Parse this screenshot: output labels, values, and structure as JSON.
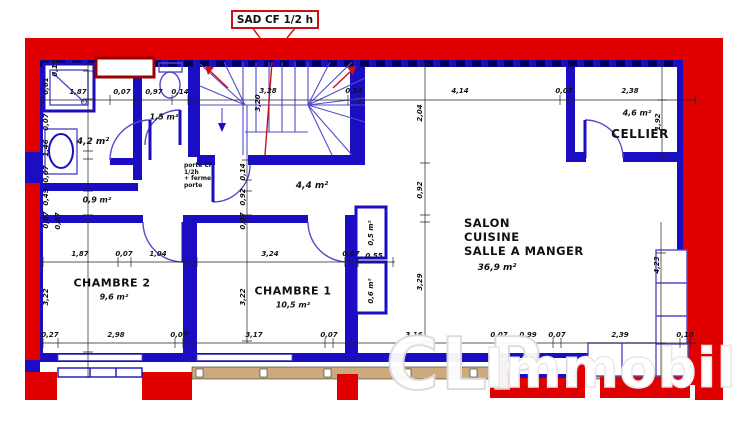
{
  "title_callout": "SAD CF 1/2 h",
  "watermark": {
    "part1": "CLP",
    "part2": "Immobilier"
  },
  "door_note": "porte CF\n1/2h\n+ ferme\nporte",
  "colors": {
    "wall_red": "#e10000",
    "wall_blue": "#1b0dc1",
    "arc_blue": "#544bc9",
    "dark_red": "#990000",
    "tan": "#cdaa7d",
    "section_red": "#cc1111"
  },
  "rooms": {
    "bathroom": {
      "area": "4,2 m²"
    },
    "wc": {
      "area": "1,5 m²"
    },
    "storage": {
      "area": "0,9 m²"
    },
    "hall": {
      "area": "4,4 m²"
    },
    "cellier": {
      "name": "CELLIER",
      "area": "4,6 m²"
    },
    "salon": {
      "line1": "SALON",
      "line2": "CUISINE",
      "line3": "SALLE A MANGER",
      "area": "36,9 m²"
    },
    "chambre2": {
      "name": "CHAMBRE 2",
      "area": "9,6 m²"
    },
    "chambre1": {
      "name": "CHAMBRE 1",
      "area": "10,5 m²"
    },
    "closet_top": {
      "area": "0,5 m²"
    },
    "closet_bottom": {
      "area": "0,6 m²"
    }
  },
  "dimensions": [
    {
      "t": "1,87",
      "x": 78,
      "y": 92,
      "r": 0
    },
    {
      "t": "0,07",
      "x": 122,
      "y": 92,
      "r": 0
    },
    {
      "t": "0,97",
      "x": 154,
      "y": 92,
      "r": 0
    },
    {
      "t": "0,14",
      "x": 180,
      "y": 92,
      "r": 0
    },
    {
      "t": "3,28",
      "x": 268,
      "y": 91,
      "r": 0
    },
    {
      "t": "0,14",
      "x": 354,
      "y": 91,
      "r": 0
    },
    {
      "t": "4,14",
      "x": 460,
      "y": 91,
      "r": 0
    },
    {
      "t": "0,07",
      "x": 564,
      "y": 91,
      "r": 0
    },
    {
      "t": "2,38",
      "x": 630,
      "y": 91,
      "r": 0
    },
    {
      "t": "0,15",
      "x": 55,
      "y": 68,
      "r": 1
    },
    {
      "t": "0,61",
      "x": 46,
      "y": 86,
      "r": 1
    },
    {
      "t": "0,07",
      "x": 46,
      "y": 122,
      "r": 1
    },
    {
      "t": "1,46",
      "x": 46,
      "y": 148,
      "r": 1
    },
    {
      "t": "0,07",
      "x": 46,
      "y": 174,
      "r": 1
    },
    {
      "t": "0,49",
      "x": 46,
      "y": 197,
      "r": 1
    },
    {
      "t": "0,07",
      "x": 46,
      "y": 220,
      "r": 1
    },
    {
      "t": "3,22",
      "x": 46,
      "y": 297,
      "r": 1
    },
    {
      "t": "1,87",
      "x": 80,
      "y": 254,
      "r": 0
    },
    {
      "t": "0,07",
      "x": 124,
      "y": 254,
      "r": 0
    },
    {
      "t": "1,04",
      "x": 158,
      "y": 254,
      "r": 0
    },
    {
      "t": "3,24",
      "x": 270,
      "y": 254,
      "r": 0
    },
    {
      "t": "0,07",
      "x": 351,
      "y": 254,
      "r": 0
    },
    {
      "t": "0,55",
      "x": 374,
      "y": 256,
      "r": 0
    },
    {
      "t": "0,27",
      "x": 50,
      "y": 335,
      "r": 0
    },
    {
      "t": "2,98",
      "x": 116,
      "y": 335,
      "r": 0
    },
    {
      "t": "0,07",
      "x": 179,
      "y": 335,
      "r": 0
    },
    {
      "t": "3,17",
      "x": 254,
      "y": 335,
      "r": 0
    },
    {
      "t": "0,07",
      "x": 329,
      "y": 335,
      "r": 0
    },
    {
      "t": "3,16",
      "x": 414,
      "y": 335,
      "r": 0
    },
    {
      "t": "0,07",
      "x": 499,
      "y": 335,
      "r": 0
    },
    {
      "t": "0,99",
      "x": 528,
      "y": 335,
      "r": 0
    },
    {
      "t": "0,07",
      "x": 557,
      "y": 335,
      "r": 0
    },
    {
      "t": "2,39",
      "x": 620,
      "y": 335,
      "r": 0
    },
    {
      "t": "0,10",
      "x": 685,
      "y": 335,
      "r": 0
    },
    {
      "t": "0,14",
      "x": 243,
      "y": 172,
      "r": 1
    },
    {
      "t": "0,92",
      "x": 243,
      "y": 197,
      "r": 1
    },
    {
      "t": "0,07",
      "x": 243,
      "y": 221,
      "r": 1
    },
    {
      "t": "3,22",
      "x": 243,
      "y": 297,
      "r": 1
    },
    {
      "t": "2,04",
      "x": 420,
      "y": 113,
      "r": 1
    },
    {
      "t": "0,92",
      "x": 420,
      "y": 190,
      "r": 1
    },
    {
      "t": "3,29",
      "x": 420,
      "y": 282,
      "r": 1
    },
    {
      "t": "1,92",
      "x": 658,
      "y": 122,
      "r": 1
    },
    {
      "t": "4,23",
      "x": 657,
      "y": 265,
      "r": 1
    },
    {
      "t": "3,20",
      "x": 258,
      "y": 103,
      "r": 1
    },
    {
      "t": "0,07",
      "x": 58,
      "y": 221,
      "r": 1
    }
  ]
}
